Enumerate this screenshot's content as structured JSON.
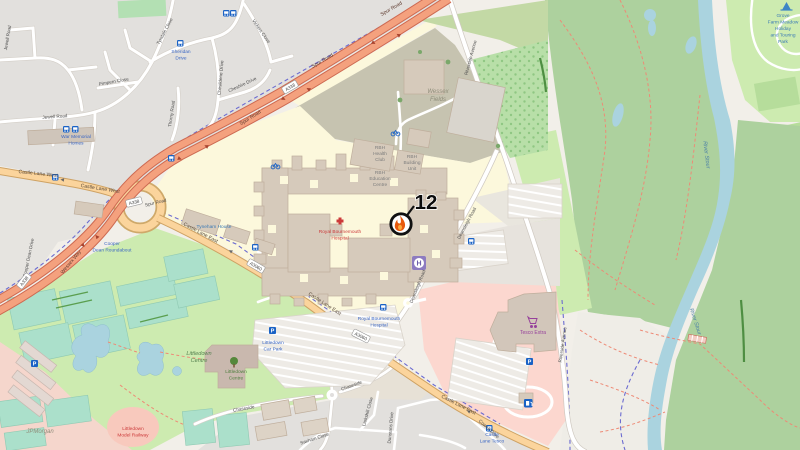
{
  "map": {
    "marker": {
      "number": "12",
      "icon": "flame-in-circle-with-needle"
    },
    "roads": {
      "spur_road": "Spur Road",
      "wessex_way": "Wessex Way",
      "castle_lane_west": "Castle Lane West",
      "castle_lane_east": "Castle Lane East",
      "deansleigh_road": "Deansleigh Road",
      "riverside_avenue": "Riverside Avenue",
      "chaseside": "Chaseside",
      "cooper_dean_drive": "Cooper Dean Drive",
      "jewell_road": "Jewell Road",
      "tyndale_close": "Tyndale Close",
      "vickers_close": "Vickers Close",
      "chesildene_drive": "Chesildene Drive",
      "cheshire_drive": "Cheshire Drive",
      "pimpern_close": "Pimpern Close",
      "thorny_road": "Thorny Road",
      "saxham_close": "Saxham Close",
      "dunstans_drive": "Dunstans Drive",
      "cowell_drive": "Cowell Drive",
      "larkshill_close": "Larkshill Close"
    },
    "shields": {
      "a338": "A338",
      "a3060": "A3060"
    },
    "areas": {
      "wessex_fields": [
        "Wessex",
        "Fields"
      ],
      "littledown_centre_area": [
        "Littledown",
        "Centre"
      ]
    },
    "pois": {
      "royal_bournemouth_hospital": [
        "Royal Bournemouth",
        "Hospital"
      ],
      "rbh_health_club": [
        "RBH",
        "Health",
        "Club"
      ],
      "rbh_education_centre": [
        "RBH",
        "Education",
        "Centre"
      ],
      "rbh_building_unit": [
        "RBH",
        "Building",
        "Unit"
      ],
      "littledown_centre": [
        "Littledown",
        "Centre"
      ],
      "littledown_car_park": [
        "Littledown",
        "Car Park"
      ],
      "littledown_model_railway": [
        "Littledown",
        "Model Railway"
      ],
      "jpmorgan": "JPMorgan",
      "tesco_extra": "Tesco Extra",
      "tyneham_house": "Tyneham House",
      "river_stour": "River Stour",
      "grove_farm": [
        "Grove",
        "Farm Meadow",
        "Holiday",
        "and Touring",
        "Park"
      ]
    },
    "bus_stops": {
      "war_memorial_homes": [
        "War Memorial",
        "Homes"
      ],
      "sheridan_drive": [
        "Sheridan",
        "Drive"
      ],
      "royal_bournemouth_hospital_stop": [
        "Royal Bournemouth",
        "Hospital"
      ],
      "castle_lane_tesco": [
        "Castle",
        "Lane Tesco"
      ],
      "cooper_dean_roundabout": [
        "Cooper",
        "Dean Roundabout"
      ]
    },
    "colors": {
      "trunk_fill": "#f4a17e",
      "trunk_casing": "#cd6a52",
      "primary_fill": "#fbd49c",
      "primary_casing": "#cea264",
      "residential": "#e2e0dd",
      "grass": "#cdebb0",
      "wood": "#add19e",
      "pitch": "#abe0cb",
      "water": "#aad3df",
      "hospital_grounds": "#fcf8dc",
      "retail_pink": "#fcd7cf",
      "building": "#d6cabb",
      "brownfield": "#c6c3b0",
      "transit_blue": "#1a62c5",
      "marker_flame": "#e8590c"
    }
  }
}
